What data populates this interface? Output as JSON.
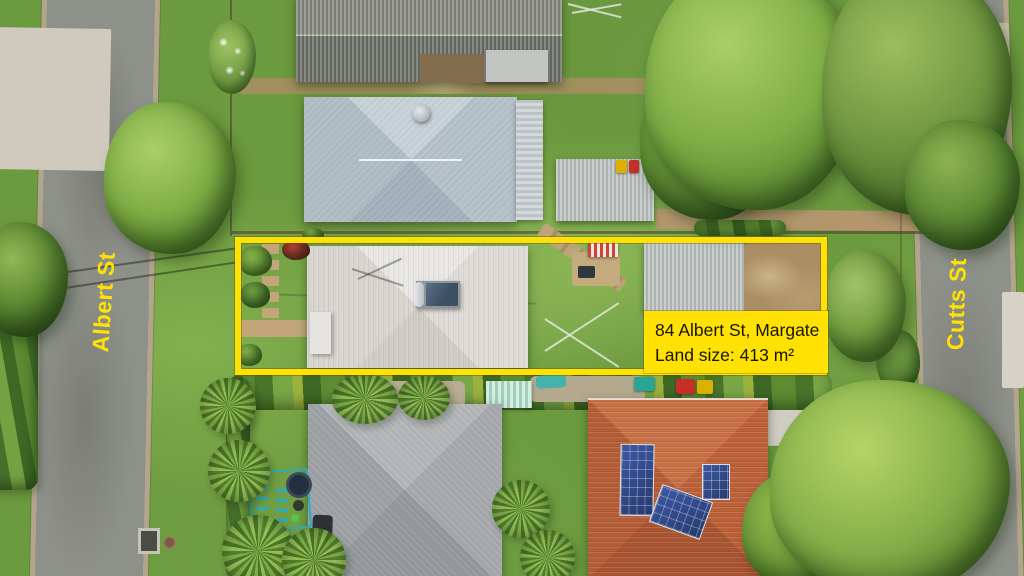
{
  "overlay": {
    "street_left": "Albert St",
    "street_right": "Cutts St",
    "info_box": {
      "line1": "84 Albert St, Margate",
      "line2": "Land size: 413 m²"
    }
  },
  "palette": {
    "accent": "#ffe203",
    "ink": "#181400"
  },
  "scene": {
    "type": "aerial-photo",
    "streets": [
      "Albert St",
      "Cutts St"
    ],
    "featured_property": {
      "address": "84 Albert St, Margate",
      "land_size": "413 m²",
      "outlined": true
    }
  }
}
